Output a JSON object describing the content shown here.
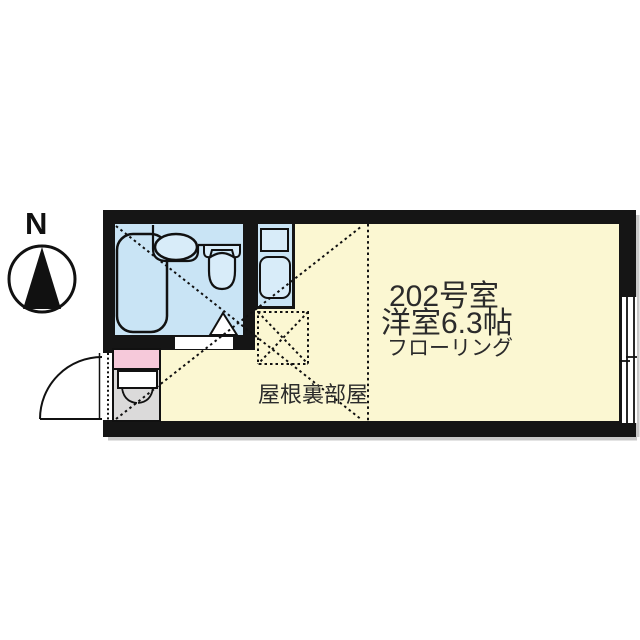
{
  "compass": {
    "north_label": "N"
  },
  "plan": {
    "room_number": "202号室",
    "room_info": "洋室6.3帖",
    "flooring": "フローリング",
    "attic_label": "屋根裏部屋"
  },
  "colors": {
    "wall": "#151515",
    "floor": "#FBF7D2",
    "wet_area": "#C9E4F5",
    "fixture": "#D8ECF9",
    "entrance_cabinet_pink": "#F6C9DA",
    "genkan_gray": "#DBDADA",
    "shadow": "#C9C9C9",
    "text": "#2B2B2B"
  }
}
